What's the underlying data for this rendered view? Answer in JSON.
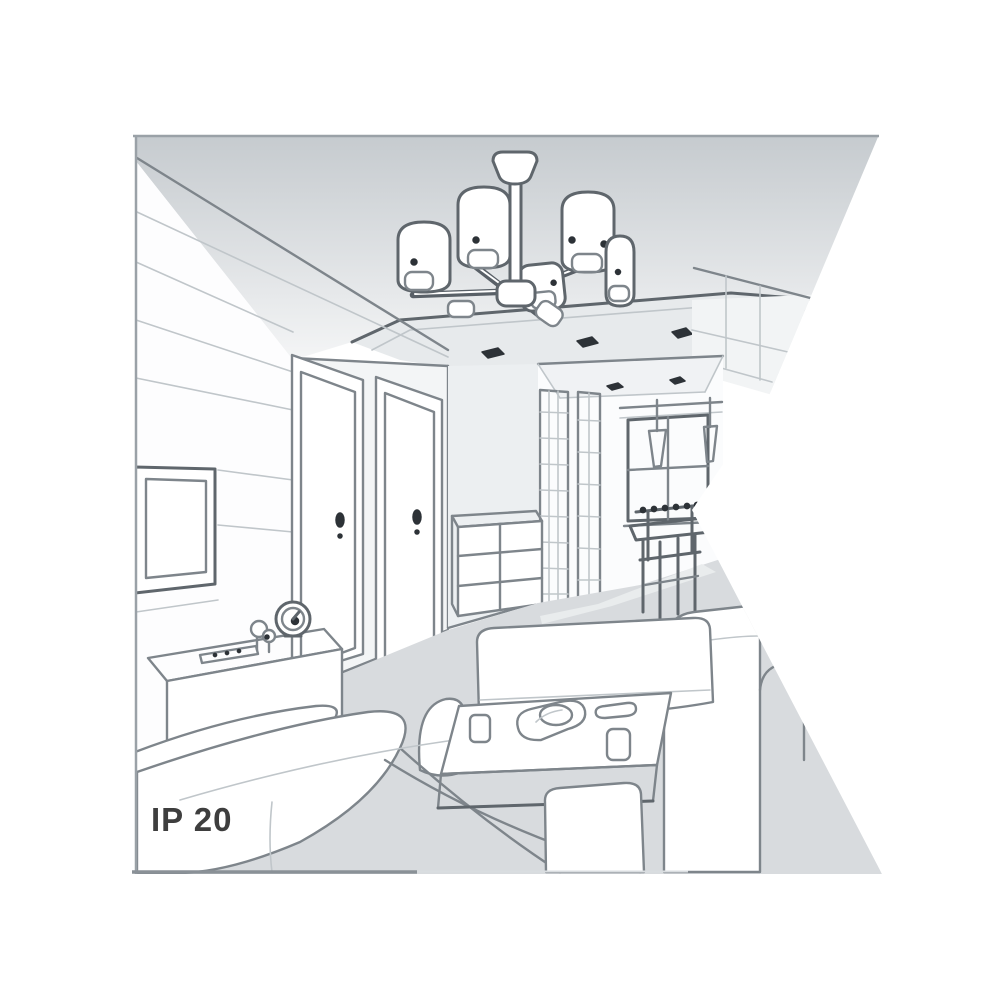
{
  "illustration": {
    "ip_rating": "IP 20",
    "colors": {
      "background": "#ffffff",
      "border": "#9aa1a7",
      "line": "#7e858b",
      "line-dark": "#5f666c",
      "line-light": "#c0c6ca",
      "white": "#ffffff",
      "light": "#f2f4f5",
      "mid": "#e7eaec",
      "floor": "#d8dbde",
      "floor-light": "#e9eced",
      "ceil-top": "#c6cbcf",
      "ceil-bottom": "#f4f5f6",
      "dot": "#2d3237",
      "text": "#3e3e3e"
    }
  }
}
